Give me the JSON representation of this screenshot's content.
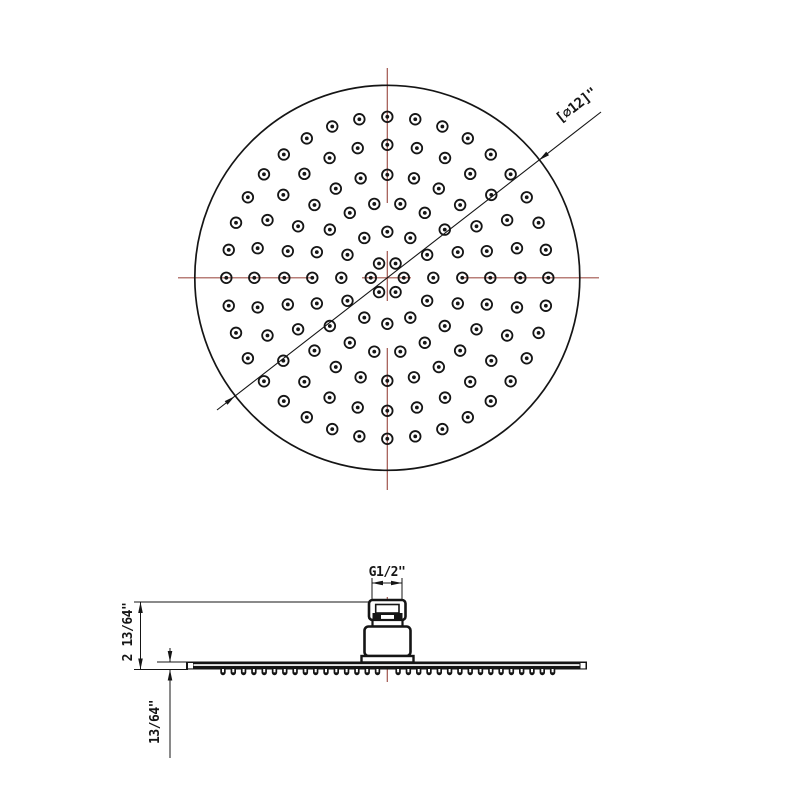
{
  "canvas": {
    "width": 800,
    "height": 800,
    "bg_color": "#ffffff",
    "line_color": "#151515",
    "centerline_color": "#a0544c"
  },
  "top_view": {
    "name": "shower-head-plan-view",
    "center_x": 387.3,
    "center_y": 277.8,
    "radius": 192.5,
    "diameter_label": "[∅12]\"",
    "dim_line": {
      "x1": 217,
      "y1": 410,
      "x2": 601,
      "y2": 112,
      "arrow_lower": {
        "x": 234.8,
        "y": 396.2,
        "angle": -37.8
      },
      "arrow_upper": {
        "x": 538.9,
        "y": 160.2,
        "angle": 142.2
      }
    },
    "nozzle_rings": [
      {
        "radius": 16.5,
        "count": 6,
        "start_deg": 0
      },
      {
        "radius": 46,
        "count": 12,
        "start_deg": 0
      },
      {
        "radius": 75,
        "count": 18,
        "start_deg": 0
      },
      {
        "radius": 103,
        "count": 24,
        "start_deg": 0
      },
      {
        "radius": 133,
        "count": 28,
        "start_deg": 0
      },
      {
        "radius": 161,
        "count": 36,
        "start_deg": 0
      }
    ],
    "nozzle_outer_r": 5.3,
    "nozzle_inner_r": 1.9,
    "centerline_vertical_x": 387.3,
    "centerline_vertical_segments": [
      [
        68,
        203
      ],
      [
        251,
        301
      ],
      [
        348,
        490
      ]
    ],
    "centerline_horizontal_y": 277.8,
    "centerline_horizontal_segments": [
      [
        178,
        311
      ],
      [
        362,
        411
      ],
      [
        462,
        599
      ]
    ]
  },
  "side_view": {
    "name": "shower-head-side-elevation",
    "center_x": 387.3,
    "g_dim": {
      "label": "G1/2\"",
      "x_left": 372,
      "x_right": 402,
      "line_y": 583,
      "ext_top": 578,
      "ext_bottom": 599
    },
    "height_dim": {
      "label": "2 13/64\"",
      "line_x": 140.5,
      "y_top": 602,
      "y_bottom": 669.5,
      "ext_x1": 134,
      "ext_top_x2": 369,
      "ext_bottom_x2": 188
    },
    "thickness_dim": {
      "label": "13/64\"",
      "line_x": 170,
      "y_top_tip": 662,
      "y_bottom_tip": 669.5,
      "tail_top": 648,
      "tail_bottom": 758,
      "ext_y": 662,
      "ext_x1": 157,
      "ext_x2": 188
    },
    "plate": {
      "x": 186,
      "y": 661.5,
      "width": 401,
      "height": 8
    },
    "teeth": {
      "x_start": 223,
      "spacing": 10.3,
      "count": 33,
      "skip": [
        16
      ],
      "width": 5.4,
      "height": 6.5
    },
    "centerline": {
      "x": 387.3,
      "y1": 597,
      "y2": 682
    }
  }
}
